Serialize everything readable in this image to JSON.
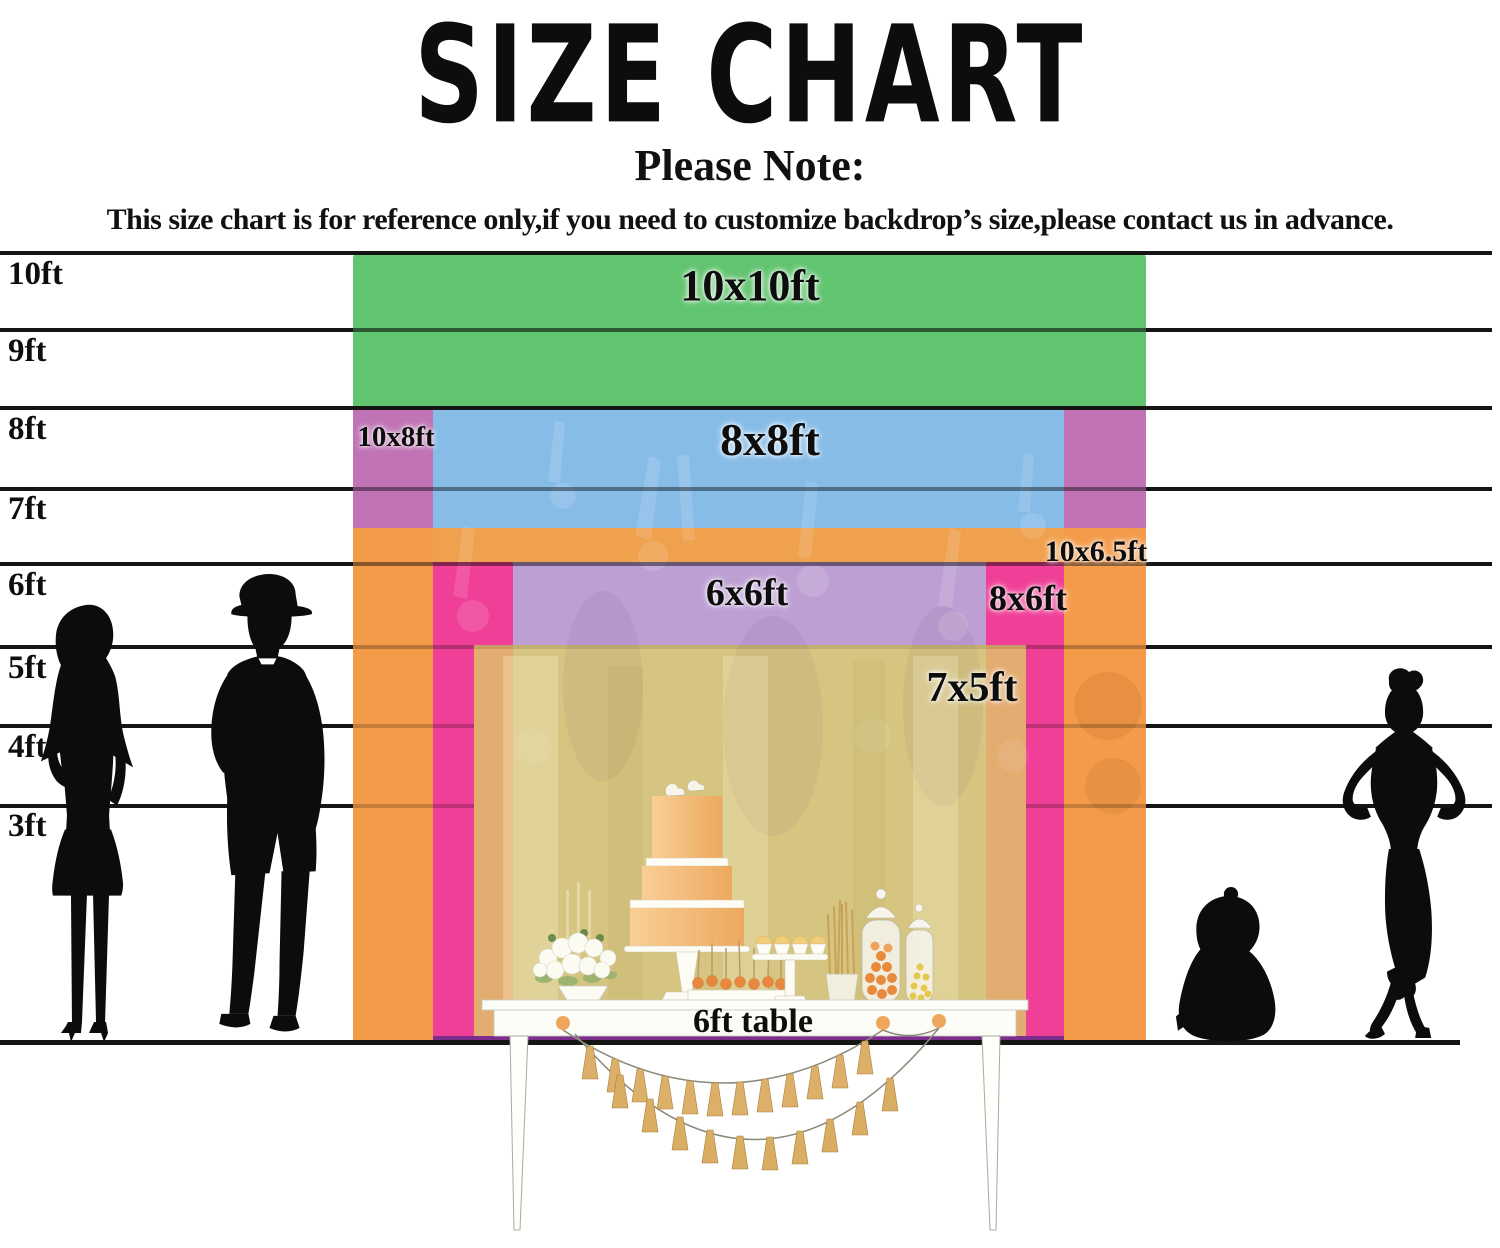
{
  "header": {
    "title": "SIZE CHART",
    "note_heading": "Please Note:",
    "note_body": "This size chart is for reference only,if you need to customize backdrop’s size,please contact us in advance."
  },
  "ruler": {
    "unit_labels": [
      "10ft",
      "9ft",
      "8ft",
      "7ft",
      "6ft",
      "5ft",
      "4ft",
      "3ft"
    ]
  },
  "backdrops": [
    {
      "label": "10x10ft",
      "width_ft": 10,
      "height_ft": 10,
      "color": "#5ec06e"
    },
    {
      "label": "10x8ft",
      "width_ft": 10,
      "height_ft": 8,
      "color": "#c173b4"
    },
    {
      "label": "8x8ft",
      "width_ft": 8,
      "height_ft": 8,
      "color": "#87bce7"
    },
    {
      "label": "10x6.5ft",
      "width_ft": 10,
      "height_ft": 6.5,
      "color": "#efa04e"
    },
    {
      "label": "6x6ft",
      "width_ft": 6,
      "height_ft": 6,
      "color": "#bda0d4"
    },
    {
      "label": "8x6ft",
      "width_ft": 8,
      "height_ft": 6,
      "color": "#ee3f98"
    },
    {
      "label": "7x5ft",
      "width_ft": 7,
      "height_ft": 5,
      "color": "#d9c87f"
    }
  ],
  "table_scene": {
    "label": "6ft table"
  },
  "silhouettes": [
    "standing-woman",
    "man-wearing-hat",
    "sitting-baby",
    "posing-woman"
  ]
}
